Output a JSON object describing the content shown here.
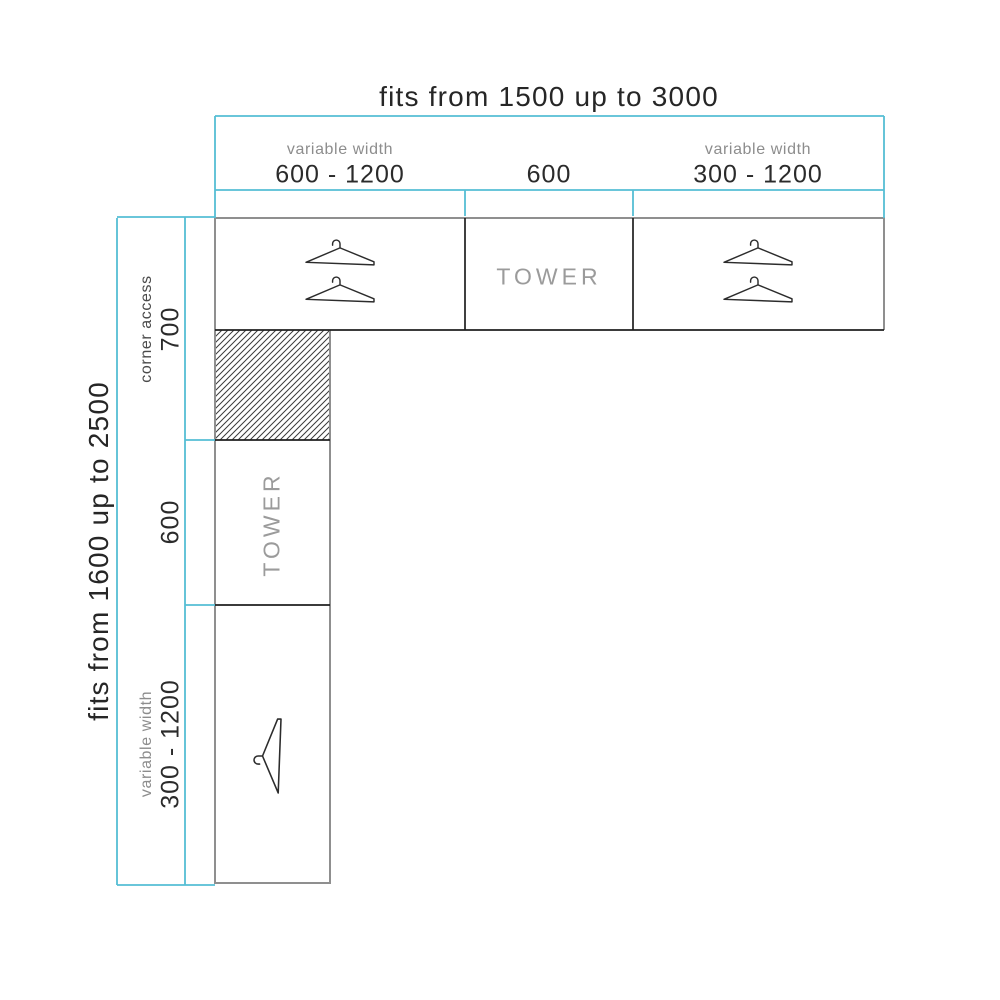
{
  "diagram": {
    "top": {
      "overall": "fits from 1500 up to 3000",
      "segments": [
        {
          "note": "variable width",
          "value": "600 - 1200"
        },
        {
          "note": "",
          "value": "600"
        },
        {
          "note": "variable width",
          "value": "300 - 1200"
        }
      ]
    },
    "left": {
      "overall": "fits from 1600 up to 2500",
      "segments": [
        {
          "note": "corner access",
          "value": "700"
        },
        {
          "note": "",
          "value": "600"
        },
        {
          "note": "variable width",
          "value": "300 - 1200"
        }
      ]
    },
    "units": {
      "top_row": [
        {
          "type": "double-hanger-section",
          "label": ""
        },
        {
          "type": "tower-section",
          "label": "TOWER"
        },
        {
          "type": "double-hanger-section",
          "label": ""
        }
      ],
      "left_column": [
        {
          "type": "corner-hatch-section",
          "label": ""
        },
        {
          "type": "tower-section",
          "label": "TOWER"
        },
        {
          "type": "single-hanger-section",
          "label": ""
        }
      ]
    },
    "colors": {
      "dimension_line": "#55bed4",
      "outline_gray": "#8f8f8f",
      "outline_dark": "#1f1f1f",
      "hanger_stroke": "#2c2c2c",
      "hatch_stroke": "#3a3a3a",
      "text_dark": "#2b2b2b",
      "text_gray": "#8d8d8d"
    }
  }
}
